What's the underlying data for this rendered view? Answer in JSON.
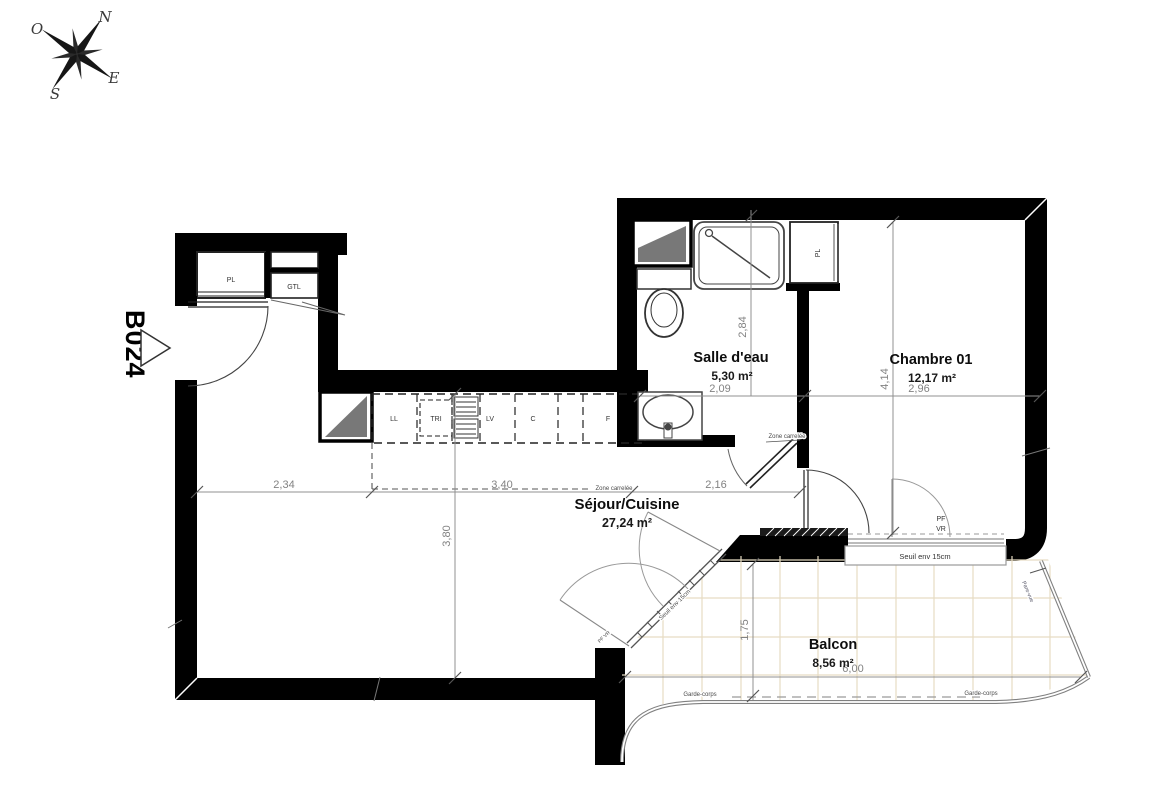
{
  "compass": {
    "north": "N",
    "west": "O",
    "east": "E",
    "south": "S"
  },
  "unit": {
    "code": "B024"
  },
  "rooms": {
    "salle_deau": {
      "name": "Salle d'eau",
      "area": "5,30 m²"
    },
    "chambre": {
      "name": "Chambre 01",
      "area": "12,17 m²"
    },
    "sejour": {
      "name": "Séjour/Cuisine",
      "area": "27,24 m²"
    },
    "balcon": {
      "name": "Balcon",
      "area": "8,56 m²"
    }
  },
  "closets": {
    "entry_pl": "PL",
    "gtl": "GTL",
    "chambre_pl": "PL"
  },
  "kitchen": {
    "ll": "LL",
    "tri": "TRI",
    "lv": "LV",
    "c": "C",
    "f": "F"
  },
  "dimensions": {
    "salle_deau_height": "2,84",
    "salle_deau_width": "2,09",
    "chambre_height": "4,14",
    "chambre_width": "2,96",
    "sejour_left": "2,34",
    "sejour_mid": "3,40",
    "sejour_right": "2,16",
    "sejour_height": "3,80",
    "balcon_height": "1,75",
    "balcon_width": "6,00"
  },
  "annotations": {
    "zone_carrelee_kitchen": "Zone carrelée",
    "zone_carrelee_bath": "Zone carrelée",
    "seuil_sejour": "Seuil env 15cm",
    "seuil_chambre": "Seuil env 15cm",
    "pf": "PF",
    "vr": "VR",
    "pf_vr_sejour": "PF VR",
    "garde_corps_left": "Garde-corps",
    "garde_corps_right": "Garde-corps",
    "pare_vue": "Pare-vue"
  },
  "colors": {
    "wall": "#000000",
    "tile": "#e7dcc3",
    "dimension": "#909090"
  }
}
